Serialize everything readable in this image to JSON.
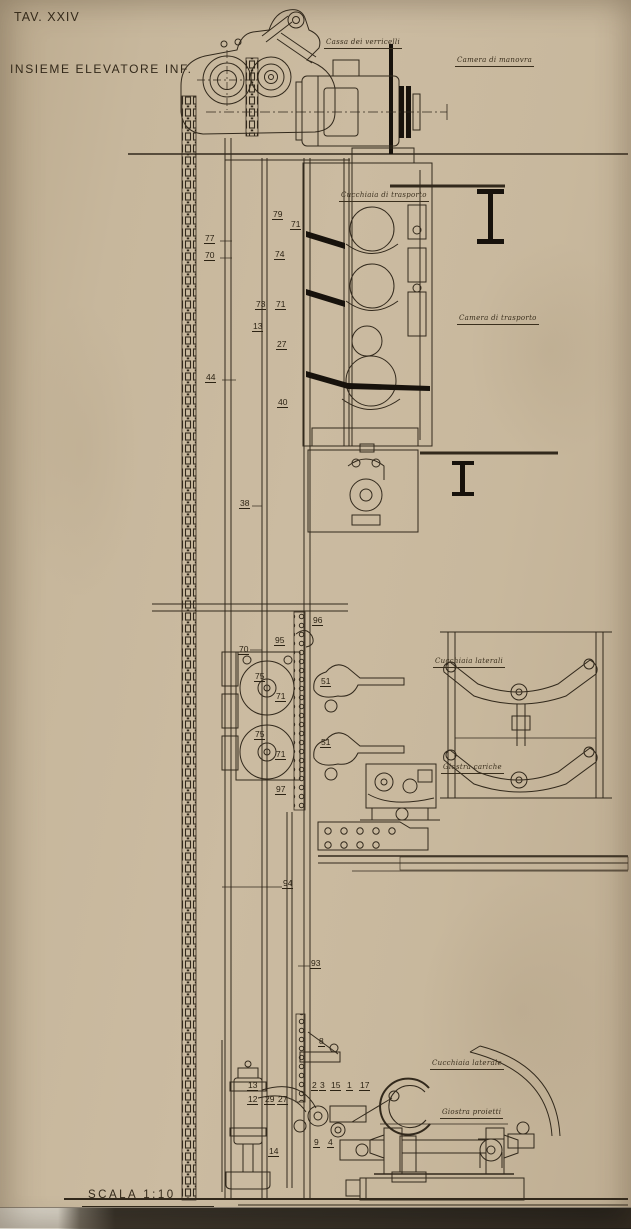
{
  "sheet": {
    "plate": "TAV. XXIV",
    "title": "INSIEME ELEVATORE INF.",
    "scale": "SCALA 1:10"
  },
  "colors": {
    "paper": "#c8b89d",
    "ink": "#32291c",
    "ink_heavy": "#17120c",
    "edge_dark": "#332e26",
    "edge_light": "#d6d1c6"
  },
  "region_labels": [
    {
      "id": "cassa-verricelli",
      "text": "Cassa dei verricelli",
      "x": 324,
      "y": 39
    },
    {
      "id": "camera-manovra",
      "text": "Camera di manovra",
      "x": 455,
      "y": 57
    },
    {
      "id": "cucchiaia-trasporto",
      "text": "Cucchiaia di trasporto",
      "x": 339,
      "y": 192
    },
    {
      "id": "camera-trasporto",
      "text": "Camera di trasporto",
      "x": 457,
      "y": 315
    },
    {
      "id": "cucchiaia-laterali",
      "text": "Cucchiaia laterali",
      "x": 433,
      "y": 658
    },
    {
      "id": "giostra-cariche",
      "text": "Giostra cariche",
      "x": 441,
      "y": 764
    },
    {
      "id": "cucchiaia-laterale",
      "text": "Cucchiaia laterale",
      "x": 430,
      "y": 1060
    },
    {
      "id": "giostra-proietti",
      "text": "Giostra proietti",
      "x": 440,
      "y": 1109
    }
  ],
  "part_numbers": [
    {
      "n": "79",
      "x": 272,
      "y": 210
    },
    {
      "n": "71",
      "x": 290,
      "y": 220
    },
    {
      "n": "77",
      "x": 204,
      "y": 234
    },
    {
      "n": "70",
      "x": 204,
      "y": 251
    },
    {
      "n": "74",
      "x": 274,
      "y": 250
    },
    {
      "n": "73",
      "x": 255,
      "y": 300
    },
    {
      "n": "71",
      "x": 275,
      "y": 300
    },
    {
      "n": "13",
      "x": 252,
      "y": 322
    },
    {
      "n": "27",
      "x": 276,
      "y": 340
    },
    {
      "n": "44",
      "x": 205,
      "y": 373
    },
    {
      "n": "40",
      "x": 277,
      "y": 398
    },
    {
      "n": "38",
      "x": 239,
      "y": 499
    },
    {
      "n": "96",
      "x": 312,
      "y": 616
    },
    {
      "n": "95",
      "x": 274,
      "y": 636
    },
    {
      "n": "70",
      "x": 238,
      "y": 645
    },
    {
      "n": "75",
      "x": 254,
      "y": 672
    },
    {
      "n": "51",
      "x": 320,
      "y": 677
    },
    {
      "n": "71",
      "x": 275,
      "y": 692
    },
    {
      "n": "75",
      "x": 254,
      "y": 730
    },
    {
      "n": "51",
      "x": 320,
      "y": 738
    },
    {
      "n": "71",
      "x": 275,
      "y": 750
    },
    {
      "n": "97",
      "x": 275,
      "y": 785
    },
    {
      "n": "94",
      "x": 282,
      "y": 879
    },
    {
      "n": "93",
      "x": 310,
      "y": 959
    },
    {
      "n": "8",
      "x": 318,
      "y": 1037
    },
    {
      "n": "13",
      "x": 247,
      "y": 1081
    },
    {
      "n": "12",
      "x": 247,
      "y": 1095
    },
    {
      "n": "29",
      "x": 264,
      "y": 1095
    },
    {
      "n": "27",
      "x": 277,
      "y": 1095
    },
    {
      "n": "2",
      "x": 311,
      "y": 1081
    },
    {
      "n": "3",
      "x": 319,
      "y": 1081
    },
    {
      "n": "15",
      "x": 330,
      "y": 1081
    },
    {
      "n": "1",
      "x": 346,
      "y": 1081
    },
    {
      "n": "17",
      "x": 359,
      "y": 1081
    },
    {
      "n": "9",
      "x": 313,
      "y": 1138
    },
    {
      "n": "4",
      "x": 327,
      "y": 1138
    },
    {
      "n": "14",
      "x": 268,
      "y": 1147
    }
  ]
}
